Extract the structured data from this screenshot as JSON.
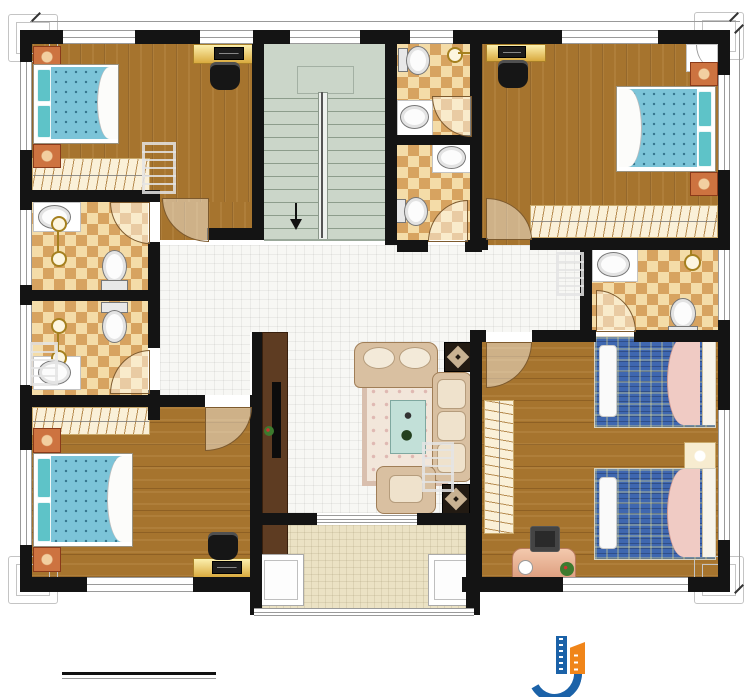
{
  "dimensions": {
    "top": "14740",
    "right": "11940"
  },
  "rooms": {
    "bedroom_tl": {
      "name": "卧室",
      "area": "17.74m²"
    },
    "bath_top": {
      "name": "内卫",
      "area": "3.25m²"
    },
    "bedroom_tr": {
      "name": "卧室",
      "area": "19.80m²"
    },
    "bath_public": {
      "name": "公卫",
      "area": "3.25m²"
    },
    "bath_left_upper": {
      "name": "内卫",
      "area": "4.62m²"
    },
    "bath_left_lower": {
      "name": "内卫",
      "area": "4.62m²"
    },
    "bath_right": {
      "name": "内卫",
      "area": "4.33m²"
    },
    "bedroom_bl": {
      "name": "卧室",
      "area": "21.25m²"
    },
    "living": {
      "name": "客厅",
      "area": "42.38m²"
    },
    "bedroom_br": {
      "name": "卧室",
      "area": "24.08m²"
    },
    "balcony": {
      "name": "阳台"
    },
    "stairs": {
      "down": "下"
    }
  },
  "title_block": {
    "title": "二层平面图1:100",
    "build_area": "本层建筑面积：175.99m²",
    "floor_height": "层高：3.6m"
  },
  "brand": {
    "name": "柏竣建筑",
    "website": "www.baijunjz.com"
  },
  "watermark": {
    "name": "柏竣建筑",
    "website": "www.baijunjz.com"
  },
  "colors": {
    "wall": "#141414",
    "wood": "#a6742e",
    "checker_dark": "#d7a360",
    "checker_light": "#f4dca8",
    "stairs": "#cbd6c9",
    "tile": "#f7f7f4",
    "balcony": "#ebe2c4",
    "bed_blue": "#7cc4d8",
    "bed_navy": "#3f67b0",
    "brand_blue": "#1b62a8",
    "brand_orange": "#f08519"
  }
}
